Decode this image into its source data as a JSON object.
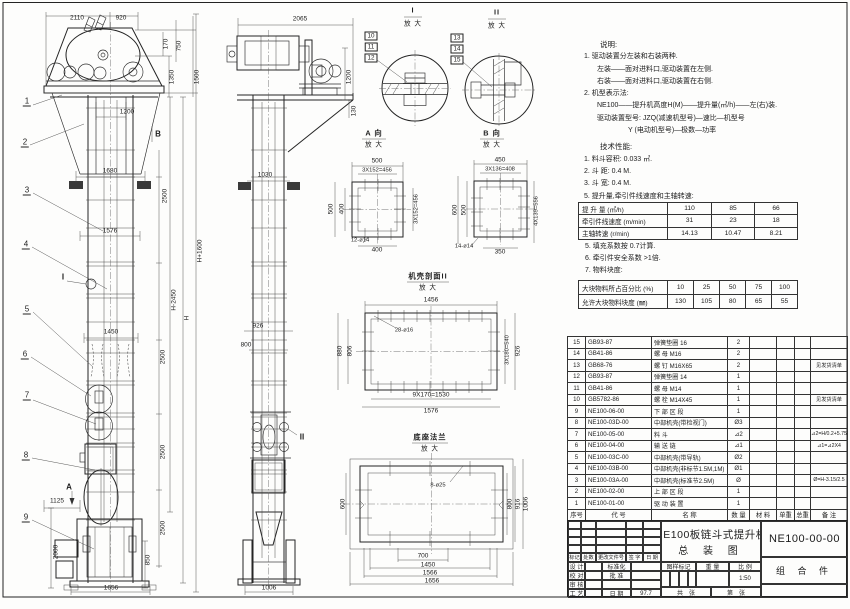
{
  "notes": {
    "title": "说明:",
    "lines": [
      "1. 驱动装置分左装和右装两种.",
      "左装——面对进料口,驱动装置在左侧.",
      "右装——面对进料口,驱动装置在右侧.",
      "2. 机型表示法:",
      "NE100——提升机高度H(M)——提升量(㎥/h)——左(右)装.",
      "驱动装置型号: JZQ(减速机型号)—速比—机型号",
      "Y (电动机型号)—极数—功率"
    ]
  },
  "tech": {
    "title": "技术性能:",
    "items": [
      "1. 料斗容积: 0.033 ㎥.",
      "2. 斗  距: 0.4 M.",
      "3. 斗  宽: 0.4 M.",
      "5. 提升量,牵引件线速度和主轴转速:"
    ],
    "items2": [
      "5. 填充系数按 0.7计算.",
      "6. 牵引件安全系数 >1倍.",
      "7. 物料块度:"
    ]
  },
  "perf_table": {
    "rows": [
      {
        "label": "提 升 量  (㎥/h)",
        "values": [
          "110",
          "85",
          "66"
        ]
      },
      {
        "label": "牵引件线速度 (m/min)",
        "values": [
          "31",
          "23",
          "18"
        ]
      },
      {
        "label": "主轴转速 (r/min)",
        "values": [
          "14.13",
          "10.47",
          "8.21"
        ]
      }
    ]
  },
  "lump_table": {
    "rows": [
      {
        "label": "大块物料所占百分比 (%)",
        "values": [
          "10",
          "25",
          "50",
          "75",
          "100"
        ]
      },
      {
        "label": "允许大块物料块度 (㎜)",
        "values": [
          "130",
          "105",
          "80",
          "65",
          "55"
        ]
      }
    ]
  },
  "bom": {
    "headers": {
      "no": "序号",
      "code": "代    号",
      "name": "名    称",
      "qty": "数 量",
      "mat": "材    料",
      "unit": "单重",
      "total": "总重",
      "remark": "备  注"
    },
    "rows": [
      {
        "no": "15",
        "code": "GB93-87",
        "name": "弹簧垫圈  16",
        "qty": "2",
        "remark": ""
      },
      {
        "no": "14",
        "code": "GB41-86",
        "name": "螺  母  M16",
        "qty": "2",
        "remark": ""
      },
      {
        "no": "13",
        "code": "GB68-76",
        "name": "螺  钉  M16X65",
        "qty": "2",
        "remark": "见发货清单"
      },
      {
        "no": "12",
        "code": "GB93-87",
        "name": "弹簧垫圈  14",
        "qty": "1",
        "remark": ""
      },
      {
        "no": "11",
        "code": "GB41-86",
        "name": "螺  母  M14",
        "qty": "1",
        "remark": ""
      },
      {
        "no": "10",
        "code": "GB5782-86",
        "name": "螺  栓  M14X45",
        "qty": "1",
        "remark": "见发货清单"
      },
      {
        "no": "9",
        "code": "NE100-06-00",
        "name": "下 部 区 段",
        "qty": "1",
        "remark": ""
      },
      {
        "no": "8",
        "code": "NE100-03D-00",
        "name": "中部机壳(带检视门)",
        "qty": "Ø3",
        "remark": ""
      },
      {
        "no": "7",
        "code": "NE100-05-00",
        "name": "料  斗",
        "qty": "⊿2",
        "remark": "⊿2=H/0.2+5.75"
      },
      {
        "no": "6",
        "code": "NE100-04-00",
        "name": "输 送 链",
        "qty": "⊿1",
        "remark": "⊿1=⊿2X4"
      },
      {
        "no": "5",
        "code": "NE100-03C-00",
        "name": "中部机壳(带导轨)",
        "qty": "Ø2",
        "remark": ""
      },
      {
        "no": "4",
        "code": "NE100-03B-00",
        "name": "中部机壳(非标节1.5M,1M)",
        "qty": "Ø1",
        "remark": ""
      },
      {
        "no": "3",
        "code": "NE100-03A-00",
        "name": "中部机壳(标准节2.5M)",
        "qty": "Ø",
        "remark": "Ø=H-3.15/2.5"
      },
      {
        "no": "2",
        "code": "NE100-02-00",
        "name": "上 部 区 段",
        "qty": "1",
        "remark": ""
      },
      {
        "no": "1",
        "code": "NE100-01-00",
        "name": "驱 动 装 置",
        "qty": "1",
        "remark": ""
      }
    ]
  },
  "title_block": {
    "title_line1": "NE100板链斗式提升机",
    "title_line2": "总 装 图",
    "drawing_no": "NE100-00-00",
    "part_type": "组 合 件",
    "rev_headers": [
      "标记",
      "处数",
      "更改文件号",
      "签 字",
      "日 期"
    ],
    "staff": [
      {
        "l": "设 计",
        "r": "标准化",
        "v": ""
      },
      {
        "l": "校 对",
        "r": "批 准",
        "v": ""
      },
      {
        "l": "审 核",
        "r": "",
        "v": ""
      },
      {
        "l": "工 艺",
        "r": "日 期",
        "v": "97.7"
      }
    ],
    "stamp_headers": [
      "图样标记",
      "重 量",
      "比 例"
    ],
    "scale": "1:50",
    "sheet_total": "共　张",
    "sheet_no": "第　张"
  },
  "annotations": [
    {
      "t": "2110",
      "x": 77,
      "y": 18
    },
    {
      "t": "920",
      "x": 121,
      "y": 18
    },
    {
      "t": "170",
      "x": 166,
      "y": 44,
      "r": 1
    },
    {
      "t": "750",
      "x": 179,
      "y": 46,
      "r": 1
    },
    {
      "t": "1350",
      "x": 172,
      "y": 77,
      "r": 1
    },
    {
      "t": "1500",
      "x": 197,
      "y": 77,
      "r": 1
    },
    {
      "t": "1200",
      "x": 127,
      "y": 112
    },
    {
      "t": "1680",
      "x": 110,
      "y": 171
    },
    {
      "t": "1576",
      "x": 110,
      "y": 231
    },
    {
      "t": "1450",
      "x": 111,
      "y": 332
    },
    {
      "t": "2500",
      "x": 165,
      "y": 196,
      "r": 1
    },
    {
      "t": "2500",
      "x": 163,
      "y": 357,
      "r": 1
    },
    {
      "t": "2500",
      "x": 163,
      "y": 452,
      "r": 1
    },
    {
      "t": "2500",
      "x": 163,
      "y": 528,
      "r": 1
    },
    {
      "t": "H-2450",
      "x": 174,
      "y": 300,
      "r": 1
    },
    {
      "t": "H",
      "x": 187,
      "y": 318,
      "r": 1
    },
    {
      "t": "H+1600",
      "x": 200,
      "y": 251,
      "r": 1
    },
    {
      "t": "1125",
      "x": 57,
      "y": 501
    },
    {
      "t": "2000",
      "x": 56,
      "y": 552,
      "r": 1
    },
    {
      "t": "850",
      "x": 148,
      "y": 560,
      "r": 1
    },
    {
      "t": "1656",
      "x": 111,
      "y": 588
    },
    {
      "t": "B",
      "x": 158,
      "y": 134,
      "cls": "mk",
      "n": "view-b-marker"
    },
    {
      "t": "A",
      "x": 69,
      "y": 487,
      "cls": "mk",
      "n": "view-a-marker"
    },
    {
      "t": "I",
      "x": 63,
      "y": 277,
      "cls": "mk",
      "n": "detail-i-marker"
    },
    {
      "t": "1",
      "x": 27,
      "y": 102,
      "cls": "bl",
      "n": "balloon-1"
    },
    {
      "t": "2",
      "x": 25,
      "y": 143,
      "cls": "bl",
      "n": "balloon-2"
    },
    {
      "t": "3",
      "x": 27,
      "y": 191,
      "cls": "bl",
      "n": "balloon-3"
    },
    {
      "t": "4",
      "x": 26,
      "y": 245,
      "cls": "bl",
      "n": "balloon-4"
    },
    {
      "t": "5",
      "x": 27,
      "y": 310,
      "cls": "bl",
      "n": "balloon-5"
    },
    {
      "t": "6",
      "x": 25,
      "y": 355,
      "cls": "bl",
      "n": "balloon-6"
    },
    {
      "t": "7",
      "x": 27,
      "y": 396,
      "cls": "bl",
      "n": "balloon-7"
    },
    {
      "t": "8",
      "x": 26,
      "y": 456,
      "cls": "bl",
      "n": "balloon-8"
    },
    {
      "t": "9",
      "x": 26,
      "y": 518,
      "cls": "bl",
      "n": "balloon-9"
    },
    {
      "t": "2065",
      "x": 300,
      "y": 19
    },
    {
      "t": "1200",
      "x": 349,
      "y": 77,
      "r": 1
    },
    {
      "t": "130",
      "x": 354,
      "y": 111,
      "r": 1
    },
    {
      "t": "1030",
      "x": 265,
      "y": 175
    },
    {
      "t": "926",
      "x": 258,
      "y": 326
    },
    {
      "t": "800",
      "x": 246,
      "y": 345
    },
    {
      "t": "1006",
      "x": 269,
      "y": 588
    },
    {
      "t": "II",
      "x": 302,
      "y": 437,
      "cls": "mk",
      "n": "detail-ii-marker"
    },
    {
      "t": "10",
      "x": 371,
      "y": 36,
      "cls": "bx",
      "n": "balloon-10"
    },
    {
      "t": "11",
      "x": 371,
      "y": 47,
      "cls": "bx",
      "n": "balloon-11"
    },
    {
      "t": "12",
      "x": 371,
      "y": 58,
      "cls": "bx",
      "n": "balloon-12"
    },
    {
      "t": "13",
      "x": 457,
      "y": 38,
      "cls": "bx",
      "n": "balloon-13"
    },
    {
      "t": "14",
      "x": 457,
      "y": 49,
      "cls": "bx",
      "n": "balloon-14"
    },
    {
      "t": "15",
      "x": 457,
      "y": 60,
      "cls": "bx",
      "n": "balloon-15"
    },
    {
      "t": "I",
      "x": 413,
      "y": 10,
      "cls": "vh",
      "n": "detail-i-title"
    },
    {
      "t": "放 大",
      "x": 413,
      "y": 24,
      "cls": "vh2"
    },
    {
      "t": "II",
      "x": 497,
      "y": 12,
      "cls": "vh",
      "n": "detail-ii-title"
    },
    {
      "t": "放 大",
      "x": 497,
      "y": 26,
      "cls": "vh2"
    },
    {
      "t": "A 向",
      "x": 374,
      "y": 133,
      "cls": "vh",
      "n": "view-a-title"
    },
    {
      "t": "放 大",
      "x": 374,
      "y": 145,
      "cls": "vh2"
    },
    {
      "t": "B 向",
      "x": 492,
      "y": 133,
      "cls": "vh",
      "n": "view-b-title"
    },
    {
      "t": "放 大",
      "x": 492,
      "y": 145,
      "cls": "vh2"
    },
    {
      "t": "机壳剖面II",
      "x": 428,
      "y": 276,
      "cls": "vh",
      "n": "casing-section-title"
    },
    {
      "t": "放 大",
      "x": 428,
      "y": 288,
      "cls": "vh2"
    },
    {
      "t": "底座法兰",
      "x": 430,
      "y": 437,
      "cls": "vh",
      "n": "base-flange-title"
    },
    {
      "t": "放 大",
      "x": 430,
      "y": 449,
      "cls": "vh2"
    },
    {
      "t": "500",
      "x": 377,
      "y": 161
    },
    {
      "t": "3X152=456",
      "x": 377,
      "y": 171,
      "cls": "sm"
    },
    {
      "t": "500",
      "x": 331,
      "y": 209,
      "r": 1
    },
    {
      "t": "400",
      "x": 342,
      "y": 209,
      "r": 1
    },
    {
      "t": "3X152=456",
      "x": 417,
      "y": 209,
      "r": 1,
      "cls": "sm"
    },
    {
      "t": "12-ø14",
      "x": 360,
      "y": 241,
      "cls": "sm"
    },
    {
      "t": "400",
      "x": 377,
      "y": 250
    },
    {
      "t": "450",
      "x": 500,
      "y": 160
    },
    {
      "t": "3X136=408",
      "x": 500,
      "y": 170,
      "cls": "sm"
    },
    {
      "t": "600",
      "x": 455,
      "y": 210,
      "r": 1
    },
    {
      "t": "500",
      "x": 464,
      "y": 210,
      "r": 1
    },
    {
      "t": "4X139=556",
      "x": 537,
      "y": 211,
      "r": 1,
      "cls": "sm"
    },
    {
      "t": "14-ø14",
      "x": 464,
      "y": 247,
      "cls": "sm"
    },
    {
      "t": "350",
      "x": 500,
      "y": 252
    },
    {
      "t": "1456",
      "x": 431,
      "y": 300
    },
    {
      "t": "28-ø16",
      "x": 404,
      "y": 331,
      "cls": "sm"
    },
    {
      "t": "880",
      "x": 340,
      "y": 351,
      "r": 1
    },
    {
      "t": "806",
      "x": 350,
      "y": 351,
      "r": 1
    },
    {
      "t": "3X180=540",
      "x": 508,
      "y": 350,
      "r": 1,
      "cls": "sm"
    },
    {
      "t": "926",
      "x": 518,
      "y": 351,
      "r": 1
    },
    {
      "t": "9X170=1530",
      "x": 431,
      "y": 395
    },
    {
      "t": "1576",
      "x": 431,
      "y": 411
    },
    {
      "t": "8-ø25",
      "x": 438,
      "y": 486,
      "cls": "sm"
    },
    {
      "t": "600",
      "x": 343,
      "y": 504,
      "r": 1
    },
    {
      "t": "800",
      "x": 510,
      "y": 504,
      "r": 1
    },
    {
      "t": "916",
      "x": 518,
      "y": 504,
      "r": 1
    },
    {
      "t": "1006",
      "x": 526,
      "y": 504,
      "r": 1
    },
    {
      "t": "700",
      "x": 423,
      "y": 556
    },
    {
      "t": "1450",
      "x": 428,
      "y": 565
    },
    {
      "t": "1566",
      "x": 430,
      "y": 573
    },
    {
      "t": "1656",
      "x": 432,
      "y": 581
    }
  ]
}
